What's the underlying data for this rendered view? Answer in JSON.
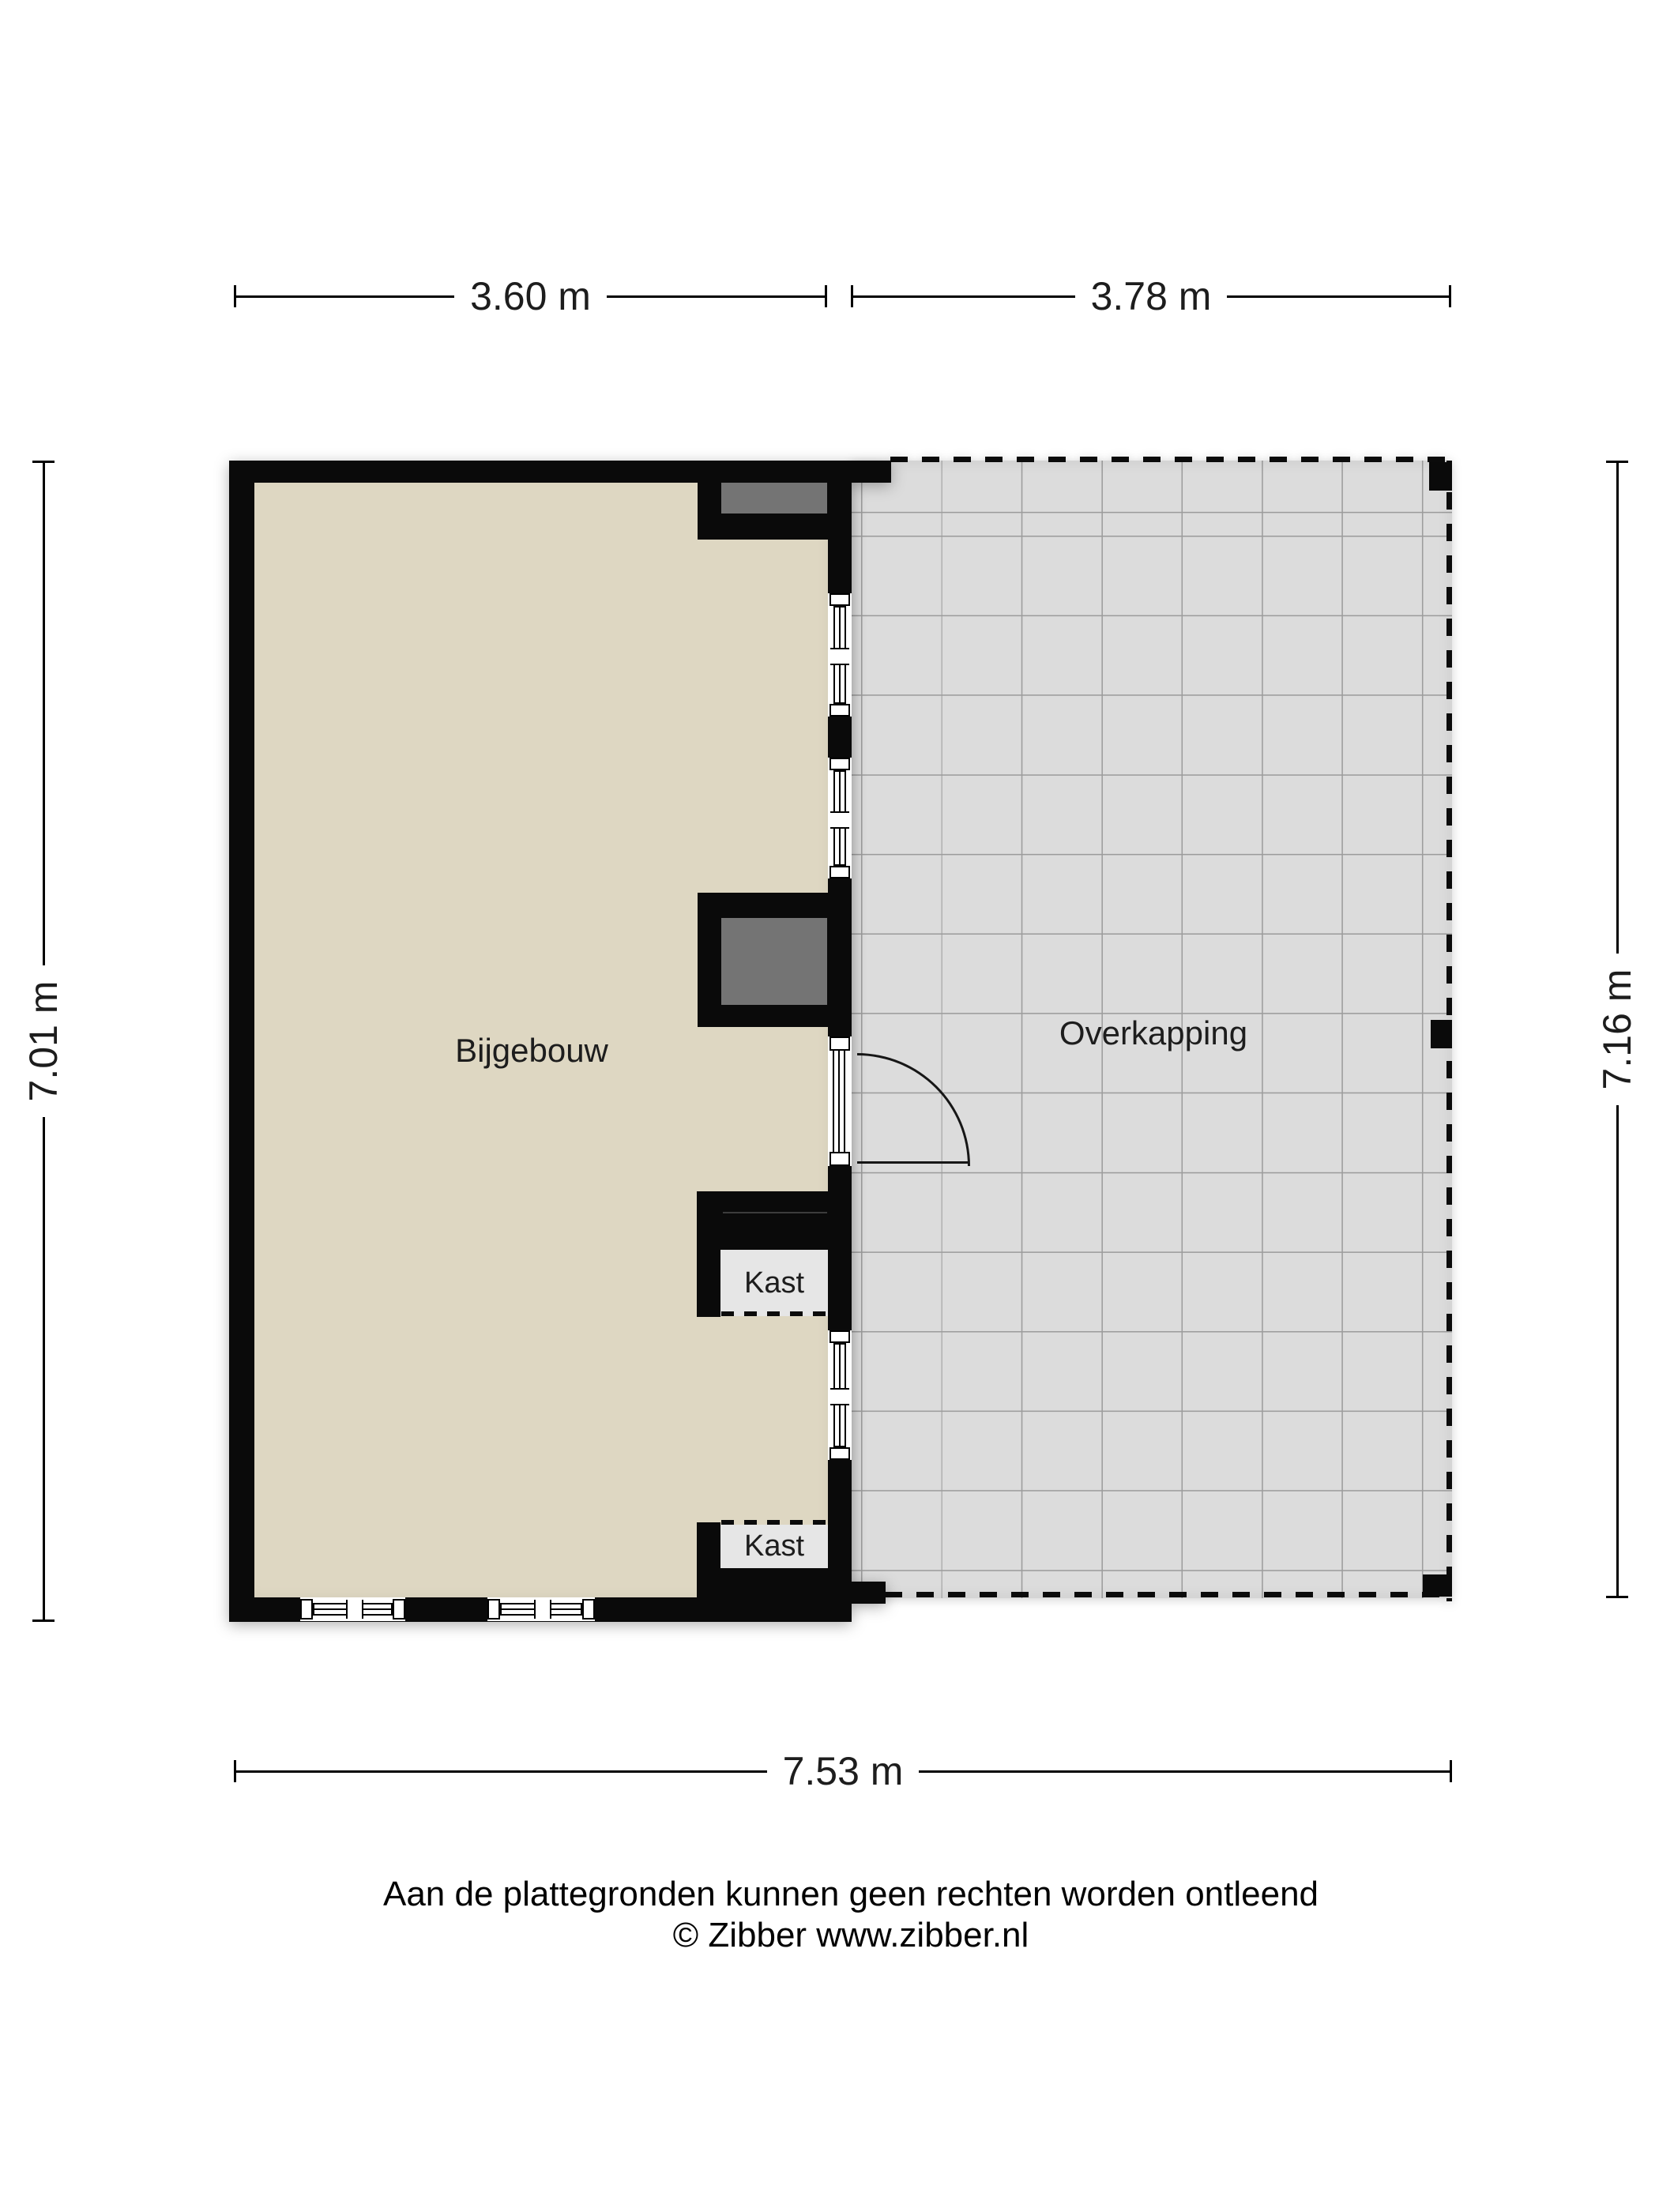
{
  "dimensions": {
    "top_left": "3.60 m",
    "top_right": "3.78 m",
    "left_side": "7.01 m",
    "right_side": "7.16 m",
    "bottom": "7.53 m"
  },
  "rooms": {
    "bijgebouw": "Bijgebouw",
    "overkapping": "Overkapping",
    "kast_upper": "Kast",
    "kast_lower": "Kast"
  },
  "footer": {
    "disclaimer": "Aan de plattegronden kunnen geen rechten worden ontleend",
    "copyright": "© Zibber www.zibber.nl"
  },
  "colors": {
    "background": "#ffffff",
    "wall": "#0a0a0a",
    "floor": "#ded7c2",
    "canopy_floor": "#dcdcdc",
    "grid_line": "#9c9c9c",
    "fixture": "#747474",
    "closet_floor": "#e6e6e6"
  }
}
